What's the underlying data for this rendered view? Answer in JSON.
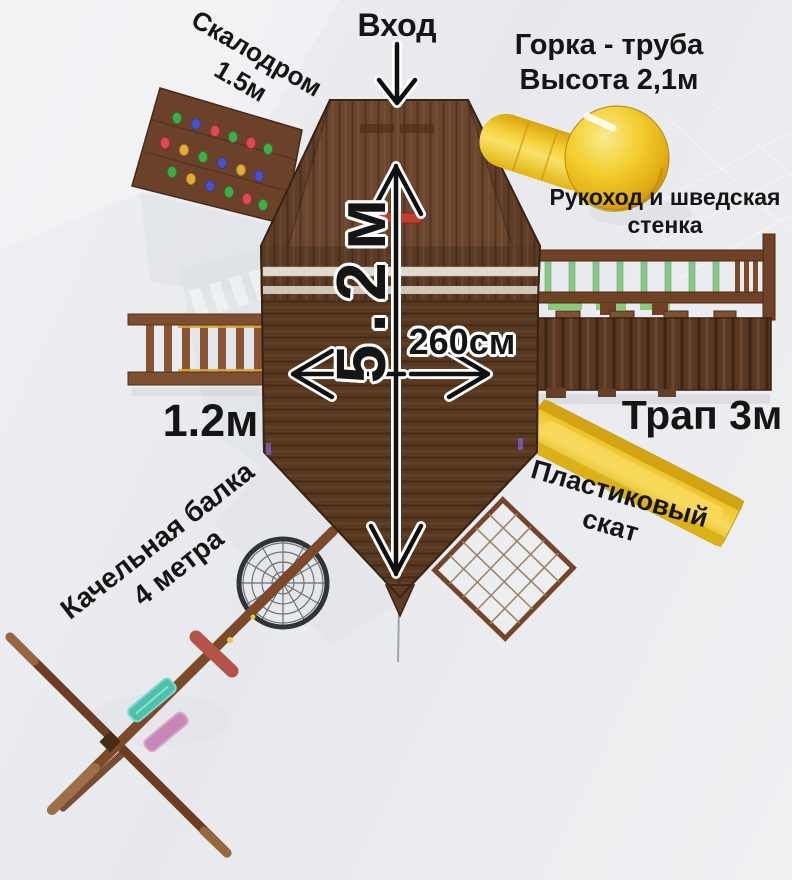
{
  "labels": {
    "entrance": "Вход",
    "tube_slide": {
      "line1": "Горка - труба",
      "line2": "Высота 2,1м"
    },
    "climbing_wall": {
      "line1": "Скалодром",
      "line2": "1.5м"
    },
    "monkey_bars": {
      "line1": "Рукоход и шведская",
      "line2": "стенка"
    },
    "length_dim": "5.2м",
    "width_dim": "260см",
    "ladder": "1.2м",
    "ramp": "Трап 3м",
    "plastic_slide": {
      "line1": "Пластиковый",
      "line2": "скат"
    },
    "swing_beam": {
      "line1": "Качельная балка",
      "line2": "4 метра"
    }
  },
  "colors": {
    "background": "#e9ebee",
    "wood": "#5d3b26",
    "wood_dark": "#3a2312",
    "wood_mid": "#6b452d",
    "wood_light": "#7b5233",
    "ramp_wood": "#5a3721",
    "slide_yellow": "#f0c52e",
    "tube_yellow": "#f2c11d",
    "rung_green": "#86c986",
    "red_bar": "#c23b30",
    "beam_red": "#b5524a",
    "seat_teal": "#4fbfae",
    "seat_pink": "#c687b8",
    "hold_green": "#3fae4a",
    "hold_blue": "#4a52c8",
    "hold_red": "#e04a58",
    "hold_yellow": "#dfae3a",
    "arrow": "#101010",
    "arrow_outline": "#ffffff",
    "text": "#151515"
  }
}
